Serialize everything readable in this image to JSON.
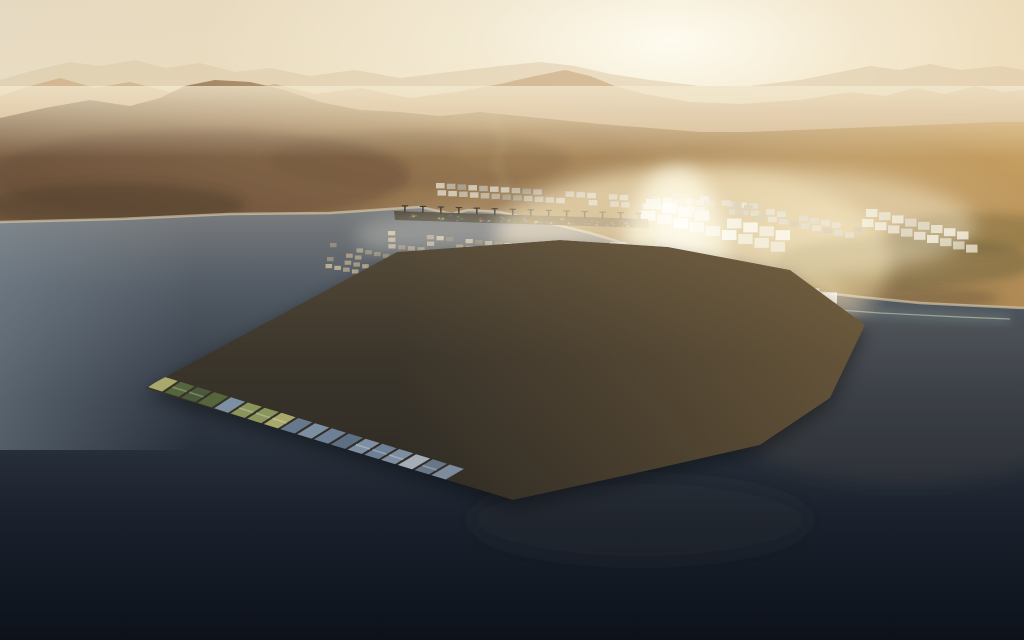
{
  "meta": {
    "title": "Aerial sunset render of a hexagonal floating port city on dark sea with hazy desert mountains behind"
  },
  "palette": {
    "sky_stops": [
      [
        0,
        "#e5d9c3",
        1
      ],
      [
        0.42,
        "#eee3c9",
        1
      ],
      [
        0.68,
        "#f2e7cf",
        1
      ],
      [
        1,
        "#e9d9b6",
        1
      ]
    ],
    "sun_core": "#fffdf2",
    "sun_wide": "#f4dca6",
    "sky_right_warm": "#e2c18a",
    "mountains_far": {
      "color": "#dcc8a8",
      "opacity": 0.5,
      "points": [
        [
          0,
          80
        ],
        [
          35,
          70
        ],
        [
          70,
          62
        ],
        [
          100,
          66
        ],
        [
          135,
          60
        ],
        [
          165,
          68
        ],
        [
          200,
          63
        ],
        [
          235,
          72
        ],
        [
          270,
          68
        ],
        [
          310,
          76
        ],
        [
          355,
          70
        ],
        [
          400,
          78
        ],
        [
          450,
          72
        ],
        [
          500,
          66
        ],
        [
          540,
          62
        ],
        [
          575,
          66
        ],
        [
          610,
          74
        ],
        [
          650,
          80
        ],
        [
          700,
          86
        ],
        [
          750,
          86
        ],
        [
          800,
          80
        ],
        [
          840,
          72
        ],
        [
          870,
          66
        ],
        [
          900,
          70
        ],
        [
          930,
          64
        ],
        [
          960,
          70
        ],
        [
          1000,
          66
        ],
        [
          1024,
          70
        ]
      ],
      "base": 135
    },
    "mountains_mid": {
      "color": "#c6a377",
      "opacity": 0.55,
      "points": [
        [
          0,
          96
        ],
        [
          30,
          86
        ],
        [
          60,
          78
        ],
        [
          95,
          88
        ],
        [
          130,
          82
        ],
        [
          170,
          92
        ],
        [
          205,
          84
        ],
        [
          240,
          90
        ],
        [
          275,
          84
        ],
        [
          315,
          94
        ],
        [
          360,
          88
        ],
        [
          410,
          98
        ],
        [
          455,
          92
        ],
        [
          500,
          84
        ],
        [
          535,
          76
        ],
        [
          565,
          70
        ],
        [
          590,
          76
        ],
        [
          615,
          86
        ],
        [
          645,
          94
        ],
        [
          690,
          102
        ],
        [
          740,
          104
        ],
        [
          800,
          100
        ],
        [
          850,
          92
        ],
        [
          885,
          96
        ],
        [
          915,
          88
        ],
        [
          945,
          94
        ],
        [
          975,
          86
        ],
        [
          1005,
          92
        ],
        [
          1024,
          90
        ]
      ],
      "base": 150
    },
    "land_stops": [
      [
        0,
        "#c7a97e",
        1
      ],
      [
        0.35,
        "#aa8a5e",
        1
      ],
      [
        0.65,
        "#90714d",
        1
      ],
      [
        1,
        "#7c6146",
        1
      ]
    ],
    "sea_stops": [
      [
        0,
        "#9a9792",
        1
      ],
      [
        0.12,
        "#7b7d7e",
        1
      ],
      [
        0.28,
        "#525a64",
        1
      ],
      [
        0.5,
        "#313944",
        1
      ],
      [
        0.75,
        "#1a212c",
        1
      ],
      [
        1,
        "#0c111a",
        1
      ]
    ],
    "island_base_stops": [
      [
        0,
        "#564b38",
        1
      ],
      [
        0.45,
        "#3b352b",
        1
      ],
      [
        1,
        "#2c2923",
        1
      ]
    ],
    "street_gold": "#bd9457",
    "haze": "#f4e9cf",
    "beach": "#d8cbae",
    "reef": "#9dbfae"
  },
  "land": {
    "hills_top": [
      [
        0,
        118
      ],
      [
        45,
        108
      ],
      [
        90,
        100
      ],
      [
        130,
        106
      ],
      [
        160,
        98
      ],
      [
        185,
        86
      ],
      [
        215,
        80
      ],
      [
        250,
        82
      ],
      [
        285,
        90
      ],
      [
        320,
        102
      ],
      [
        360,
        110
      ],
      [
        400,
        112
      ],
      [
        440,
        116
      ],
      [
        480,
        112
      ],
      [
        520,
        116
      ],
      [
        560,
        120
      ],
      [
        600,
        124
      ],
      [
        650,
        128
      ],
      [
        700,
        132
      ],
      [
        750,
        132
      ],
      [
        800,
        130
      ],
      [
        850,
        128
      ],
      [
        900,
        126
      ],
      [
        950,
        124
      ],
      [
        1000,
        122
      ],
      [
        1024,
        122
      ]
    ],
    "coast": [
      [
        0,
        222
      ],
      [
        120,
        219
      ],
      [
        230,
        214
      ],
      [
        330,
        213
      ],
      [
        420,
        207
      ],
      [
        452,
        214
      ],
      [
        468,
        210
      ],
      [
        500,
        212
      ],
      [
        545,
        222
      ],
      [
        590,
        233
      ],
      [
        640,
        248
      ],
      [
        690,
        262
      ],
      [
        740,
        278
      ],
      [
        800,
        290
      ],
      [
        860,
        297
      ],
      [
        920,
        303
      ],
      [
        980,
        306
      ],
      [
        1024,
        308
      ]
    ],
    "mottles": [
      {
        "x": 200,
        "y": 175,
        "rx": 210,
        "ry": 46,
        "c": "rgba(90,62,44,0.38)"
      },
      {
        "x": 115,
        "y": 205,
        "rx": 130,
        "ry": 22,
        "c": "rgba(70,52,38,0.4)"
      },
      {
        "x": 420,
        "y": 160,
        "rx": 150,
        "ry": 30,
        "c": "rgba(105,80,52,0.3)"
      },
      {
        "x": 545,
        "y": 150,
        "rx": 90,
        "ry": 24,
        "c": "rgba(165,136,90,0.35)"
      },
      {
        "x": 905,
        "y": 262,
        "rx": 130,
        "ry": 26,
        "c": "rgba(88,78,44,0.38)"
      },
      {
        "x": 975,
        "y": 233,
        "rx": 90,
        "ry": 20,
        "c": "rgba(96,84,48,0.34)"
      },
      {
        "x": 850,
        "y": 298,
        "rx": 150,
        "ry": 14,
        "c": "rgba(70,64,40,0.3)"
      }
    ],
    "wadi": [
      [
        500,
        100
      ],
      [
        492,
        122
      ],
      [
        505,
        142
      ],
      [
        495,
        165
      ],
      [
        508,
        186
      ],
      [
        482,
        200
      ],
      [
        460,
        208
      ]
    ],
    "reef_band": [
      [
        730,
        300
      ],
      [
        800,
        307
      ],
      [
        880,
        313
      ],
      [
        960,
        317
      ],
      [
        1010,
        319
      ]
    ]
  },
  "sea": {
    "top": 150,
    "dark_mottles": [
      {
        "x": 640,
        "y": 520,
        "rx": 170,
        "ry": 42,
        "c": "rgba(58,56,50,0.22)"
      },
      {
        "x": 905,
        "y": 395,
        "rx": 200,
        "ry": 90,
        "c": "rgba(120,98,76,0.14)"
      }
    ]
  },
  "glints": [
    {
      "x": 470,
      "y": 236,
      "rx": 115,
      "ry": 26,
      "c": "rgba(195,185,162,0.35)"
    },
    {
      "x": 690,
      "y": 262,
      "rx": 200,
      "ry": 95,
      "c": "rgba(222,186,120,0.5)"
    },
    {
      "x": 676,
      "y": 256,
      "rx": 52,
      "ry": 88,
      "c": "rgba(255,246,216,0.8)"
    },
    {
      "x": 678,
      "y": 238,
      "rx": 24,
      "ry": 46,
      "c": "rgba(255,252,236,0.9)"
    },
    {
      "x": 715,
      "y": 296,
      "rx": 135,
      "ry": 22,
      "c": "rgba(240,210,150,0.45)"
    },
    {
      "x": 735,
      "y": 225,
      "rx": 240,
      "ry": 58,
      "c": "rgba(247,231,196,0.4)"
    }
  ],
  "port": {
    "groups": [
      {
        "name": "land-industrial-a",
        "o": [
          436,
          183
        ],
        "u": [
          10.8,
          0.7
        ],
        "v": [
          1.5,
          7.2
        ],
        "cols": 30,
        "rows": 2,
        "w": 8.6,
        "h": 5.4,
        "colors": [
          "#c2bba9",
          "#d3ccba",
          "#aaa391",
          "#bcb2a0"
        ],
        "skip": 0.18
      },
      {
        "name": "land-industrial-b",
        "o": [
          700,
          196
        ],
        "u": [
          11,
          2.2
        ],
        "v": [
          2,
          7.5
        ],
        "cols": 15,
        "rows": 2,
        "w": 8.8,
        "h": 5.6,
        "colors": [
          "#c2bba9",
          "#cdc5b2",
          "#a89f8d"
        ],
        "skip": 0.25
      },
      {
        "name": "warehouses-upper",
        "o": [
          646,
          199
        ],
        "u": [
          16.2,
          3.9
        ],
        "v": [
          -5,
          11.5
        ],
        "cols": 9,
        "rows": 2,
        "w": 14.5,
        "h": 10,
        "colors": [
          "#e8e1ca",
          "#f2ecd9",
          "#d9d1b8",
          "#e0d8c0"
        ],
        "skip": 0.08
      },
      {
        "name": "warehouses-main",
        "o": [
          610,
          242
        ],
        "u": [
          17.6,
          4.2
        ],
        "v": [
          -6.5,
          12.8
        ],
        "cols": 13,
        "rows": 3,
        "w": 15.8,
        "h": 11,
        "colors": [
          "#efe9d4",
          "#f6f1e0",
          "#e2dac2",
          "#d4cbb1"
        ],
        "skip": 0.06
      },
      {
        "name": "warehouses-right-coast",
        "o": [
          866,
          209
        ],
        "u": [
          13,
          3.2
        ],
        "v": [
          -4,
          10
        ],
        "cols": 9,
        "rows": 2,
        "w": 11.5,
        "h": 8,
        "colors": [
          "#ddd3ba",
          "#cfc5ac",
          "#e6ddc6"
        ],
        "skip": 0.15
      },
      {
        "name": "marina-main",
        "o": [
          388,
          231
        ],
        "u": [
          9.7,
          1.0
        ],
        "v": [
          0.2,
          6.6
        ],
        "cols": 27,
        "rows": 3,
        "w": 7.2,
        "h": 4.3,
        "colors": [
          "#bdb096",
          "#99907c",
          "#ab9f87",
          "#cabda1",
          "#8a8270"
        ],
        "skip": 0.3
      },
      {
        "name": "marina-left-islets",
        "o": [
          330,
          243
        ],
        "u": [
          8.8,
          1.8
        ],
        "v": [
          -1.5,
          7
        ],
        "cols": 8,
        "rows": 4,
        "w": 6.6,
        "h": 4.2,
        "colors": [
          "#bdb096",
          "#99907c",
          "#ab9f87"
        ],
        "skip": 0.35
      },
      {
        "name": "marina-right",
        "o": [
          652,
          252
        ],
        "u": [
          10.2,
          2.6
        ],
        "v": [
          0.5,
          7
        ],
        "cols": 16,
        "rows": 2,
        "w": 7.6,
        "h": 4.6,
        "colors": [
          "#a89d85",
          "#8f8673",
          "#bcae92"
        ],
        "skip": 0.35
      }
    ],
    "pier": {
      "pts": [
        [
          394,
          211
        ],
        [
          648,
          219
        ],
        [
          649,
          228
        ],
        [
          395,
          220
        ]
      ],
      "color": "#4b4437"
    },
    "crane_count": 14,
    "crane_color": "#332d24",
    "container_colors": [
      "#a24436",
      "#31608f",
      "#b98f3e",
      "#3f7a52",
      "#8a8a88",
      "#7a4a86"
    ],
    "container_count": 55
  },
  "island": {
    "outline": [
      [
        145,
        388
      ],
      [
        397,
        252
      ],
      [
        560,
        240
      ],
      [
        668,
        247
      ],
      [
        790,
        270
      ],
      [
        865,
        325
      ],
      [
        830,
        398
      ],
      [
        760,
        445
      ],
      [
        650,
        470
      ],
      [
        513,
        500
      ]
    ],
    "quad": [
      [
        145,
        388
      ],
      [
        410,
        208
      ],
      [
        940,
        290
      ],
      [
        540,
        515
      ]
    ],
    "cols": 24,
    "rows": 18,
    "palettes": {
      "slate": [
        "#6e8095",
        "#5d6f84",
        "#7d8fa3",
        "#4e5e70",
        "#8a9bae",
        "#66788c"
      ],
      "dark": [
        "#3f4a58",
        "#45525f",
        "#39434f"
      ],
      "light": [
        "#b9c2cb",
        "#cdd4d8",
        "#a5b1bd",
        "#dfe2e0"
      ],
      "green": [
        "#55653c",
        "#6b7a47",
        "#8a955c",
        "#a8a96b",
        "#49593a"
      ]
    },
    "haze_tint": "#c3ab82",
    "warm_tint": "#7b6a50",
    "inlet": {
      "pts": [
        [
          488,
          251
        ],
        [
          516,
          249
        ],
        [
          523,
          271
        ],
        [
          495,
          275
        ]
      ],
      "color": "#c4a876"
    },
    "corner_piers": [
      [
        852,
        330,
        890,
        352
      ],
      [
        846,
        344,
        882,
        367
      ]
    ],
    "accents": [
      {
        "x": 505,
        "y": 299,
        "w": 7,
        "h": 4.5,
        "c": "#7fb6c9"
      },
      {
        "x": 662,
        "y": 311,
        "w": 5,
        "h": 3.5,
        "c": "#c07a3a"
      },
      {
        "x": 560,
        "y": 388,
        "w": 5,
        "h": 3,
        "c": "#b8863e"
      },
      {
        "x": 418,
        "y": 330,
        "w": 5,
        "h": 3,
        "c": "#7fae52"
      }
    ]
  },
  "ships": [
    {
      "type": "cargo",
      "x": 845,
      "y": 304,
      "w": 36,
      "h": 9,
      "hull": "#30231e",
      "deck": "#833c30",
      "wake_dx": 42,
      "wake_dy": -2
    },
    {
      "type": "ferry",
      "x": 504,
      "y": 236,
      "w": 17,
      "h": 6,
      "hull": "#e6e1d3",
      "wake_dx": 0,
      "wake_dy": 0
    },
    {
      "type": "barge",
      "x": 616,
      "y": 271,
      "w": 14,
      "h": 7,
      "hull": "#3c352a",
      "wake_dx": 0,
      "wake_dy": 0
    }
  ],
  "boats": [
    {
      "x": 57,
      "y": 417,
      "dx": -13,
      "dy": -5,
      "s": 3
    },
    {
      "x": 82,
      "y": 252,
      "dx": -8,
      "dy": 1,
      "s": 1.8
    },
    {
      "x": 143,
      "y": 253,
      "dx": -9,
      "dy": 1,
      "s": 1.8
    },
    {
      "x": 935,
      "y": 403,
      "dx": 24,
      "dy": -6,
      "s": 3
    },
    {
      "x": 812,
      "y": 509,
      "dx": 26,
      "dy": -4,
      "s": 3.4
    },
    {
      "x": 947,
      "y": 316,
      "dx": 14,
      "dy": -2,
      "s": 2.2
    },
    {
      "x": 588,
      "y": 285,
      "dx": 10,
      "dy": 3,
      "s": 2
    }
  ],
  "specks": [
    [
      447,
      258
    ],
    [
      466,
      252
    ],
    [
      484,
      257
    ],
    [
      508,
      252
    ],
    [
      527,
      256
    ],
    [
      549,
      251
    ],
    [
      566,
      257
    ],
    [
      585,
      252
    ],
    [
      603,
      257
    ],
    [
      627,
      254
    ],
    [
      650,
      259
    ],
    [
      673,
      261
    ],
    [
      697,
      264
    ],
    [
      718,
      268
    ],
    [
      745,
      274
    ],
    [
      372,
      252
    ],
    [
      356,
      247
    ],
    [
      420,
      257
    ]
  ]
}
